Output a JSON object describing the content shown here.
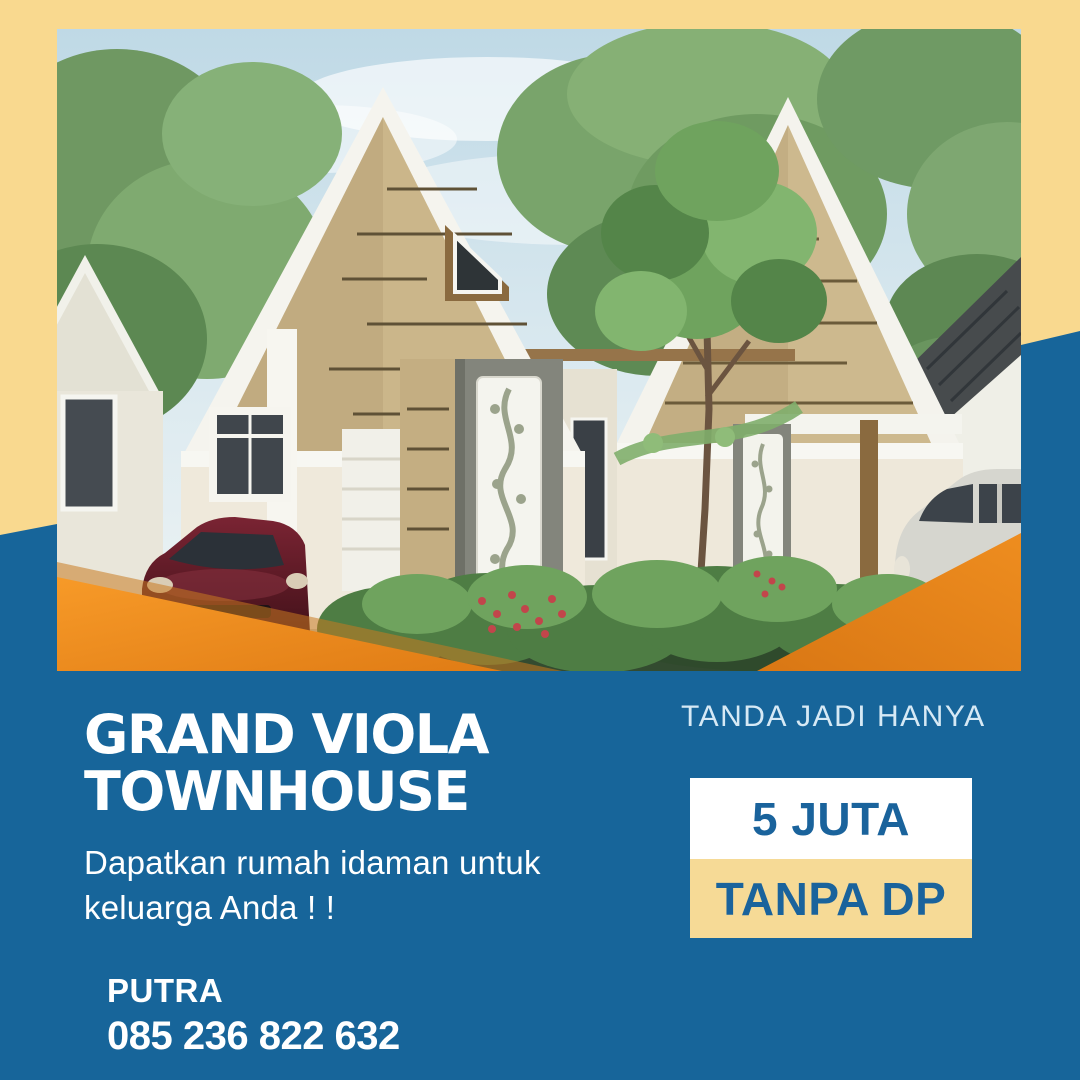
{
  "poster": {
    "colors": {
      "background_cream": "#F9D98F",
      "primary_blue": "#17659A",
      "accent_orange": "#F18A1E",
      "box_yellow": "#F6DA96",
      "price_text_blue": "#1A639C",
      "offer_label_blue": "#D6E9F5",
      "headline_white": "#FFFFFF"
    }
  },
  "headline": {
    "line1": "GRAND VIOLA",
    "line2": "TOWNHOUSE"
  },
  "tagline": {
    "line1": "Dapatkan rumah idaman untuk",
    "line2": "keluarga Anda ! !"
  },
  "offer": {
    "label": "TANDA JADI HANYA",
    "price": "5 JUTA",
    "note": "TANPA DP"
  },
  "contact": {
    "name": "PUTRA",
    "phone": "085 236 822 632"
  },
  "photo": {
    "license_plate": "HH LM 968"
  }
}
